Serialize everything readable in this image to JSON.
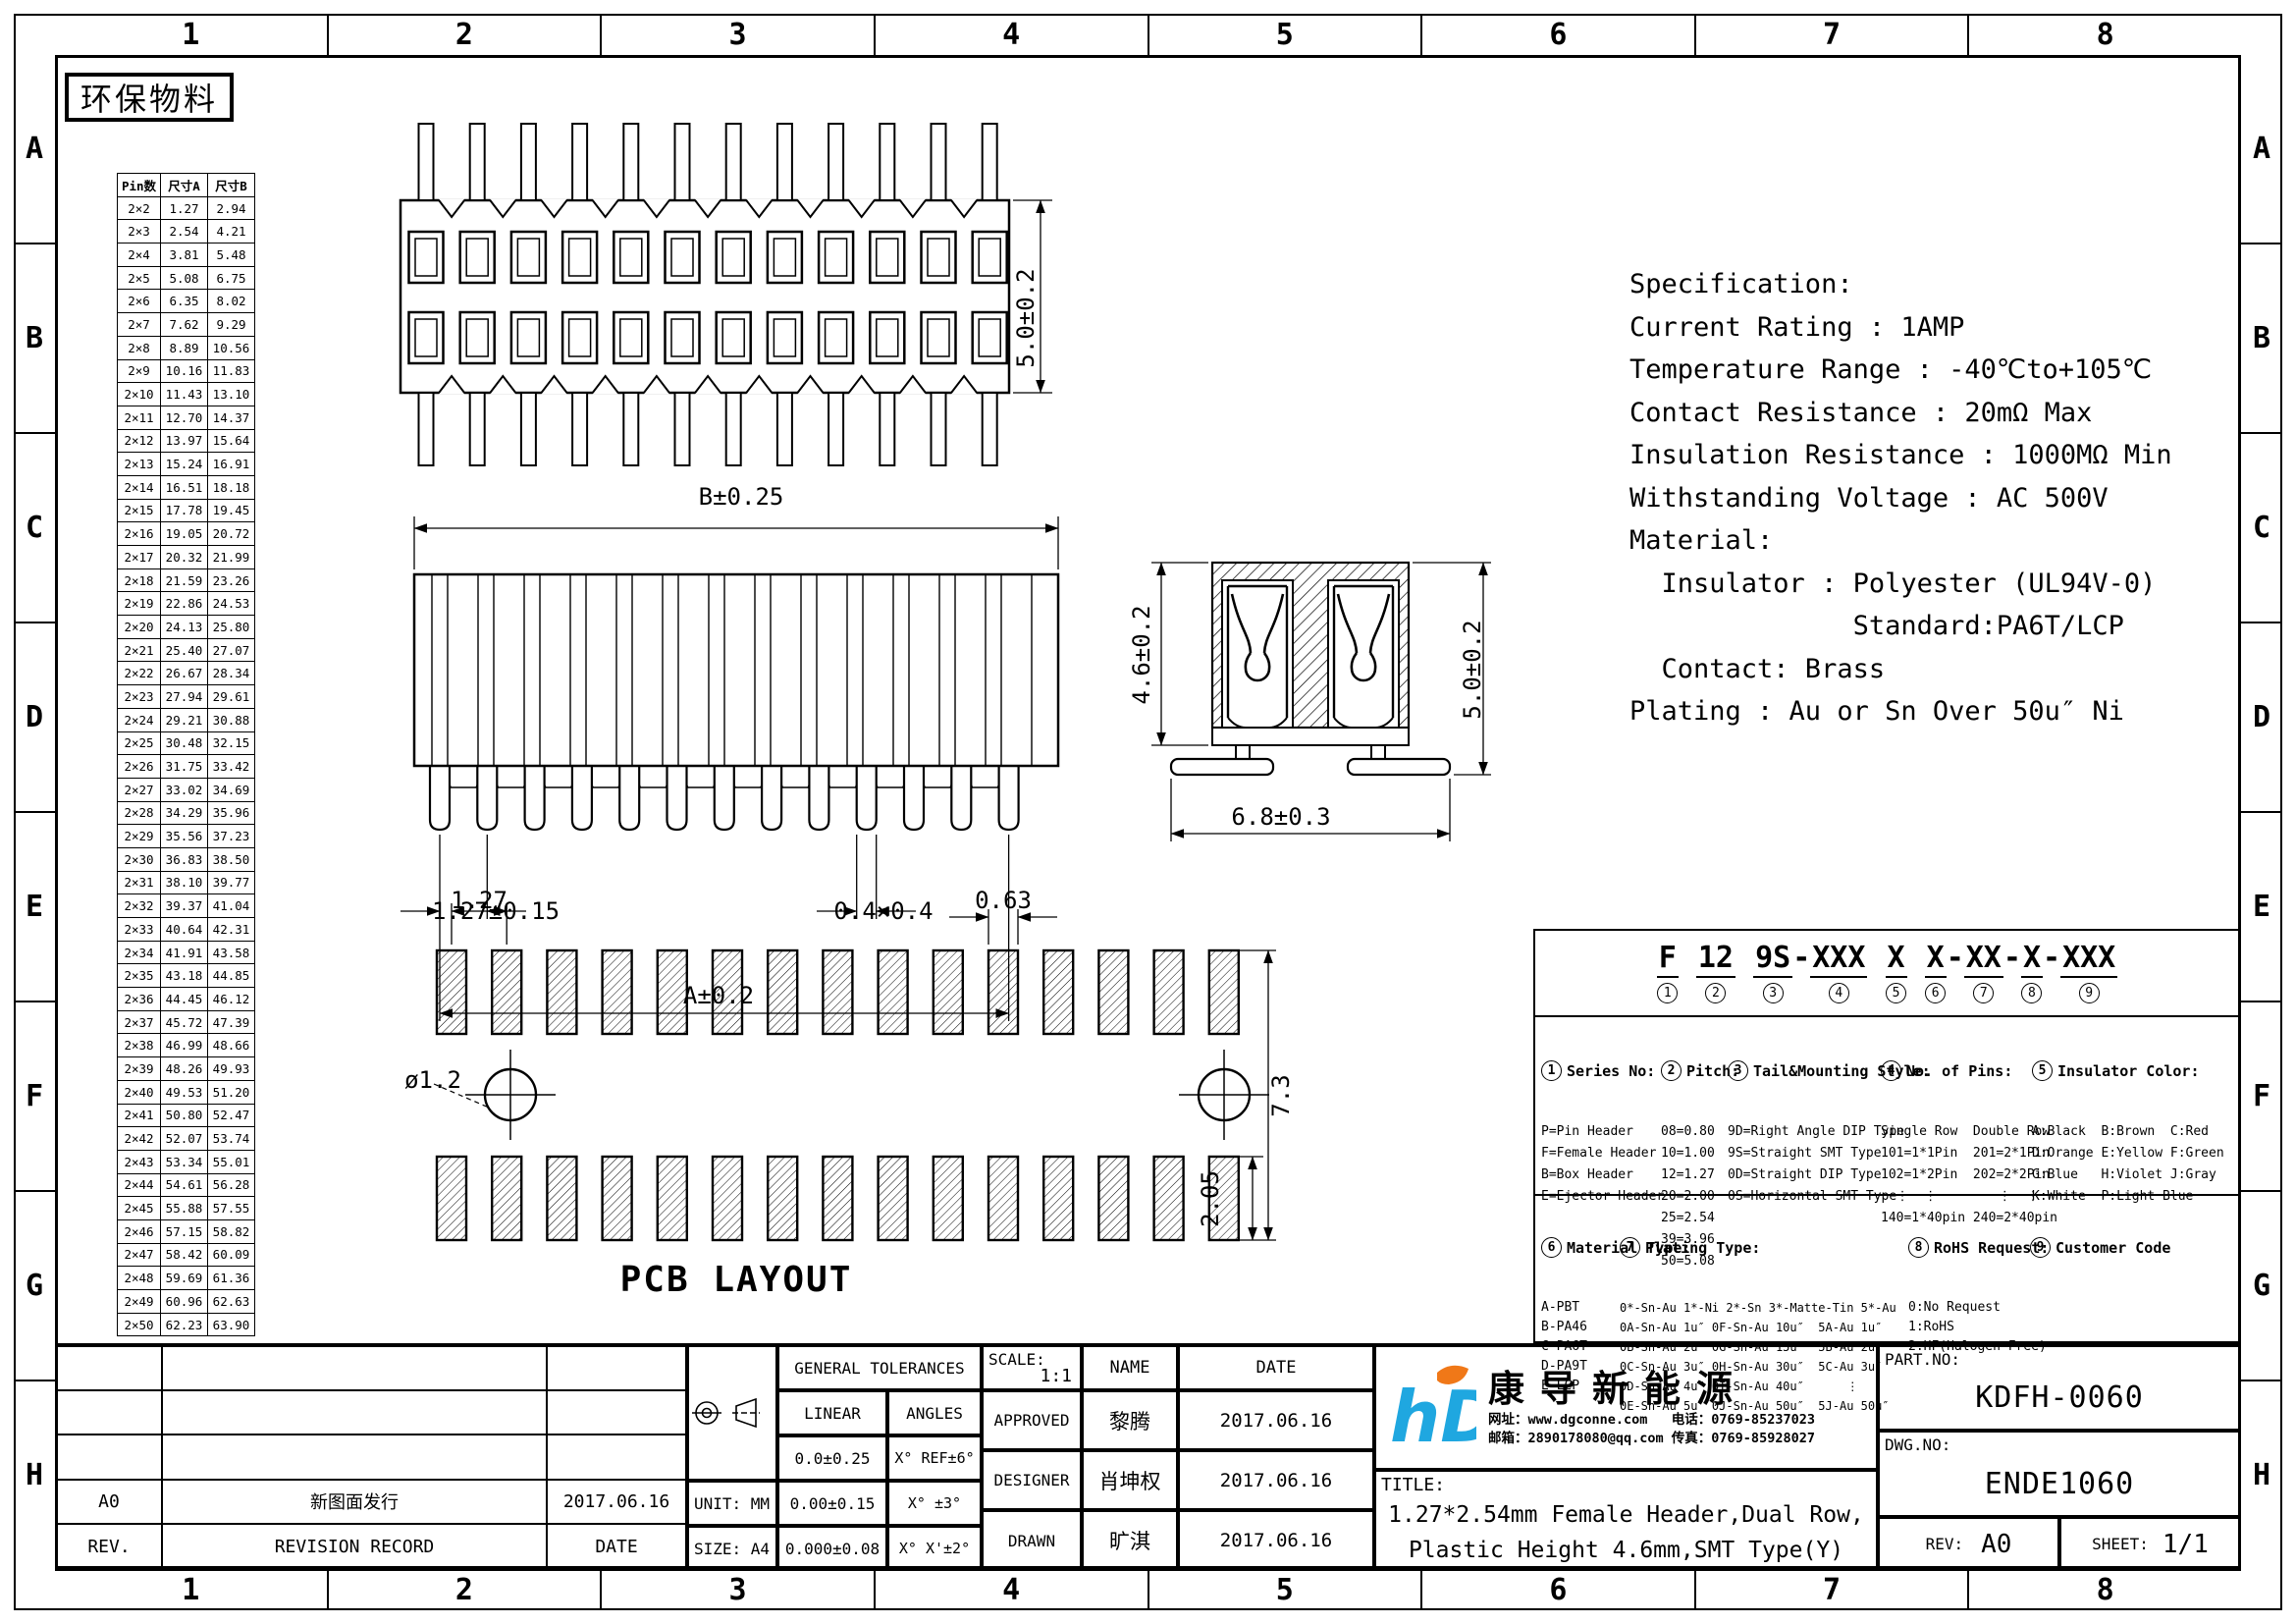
{
  "stamp": "环保物料",
  "zones": {
    "cols": [
      "1",
      "2",
      "3",
      "4",
      "5",
      "6",
      "7",
      "8"
    ],
    "rows": [
      "A",
      "B",
      "C",
      "D",
      "E",
      "F",
      "G",
      "H"
    ]
  },
  "pin_table": {
    "headers": [
      "Pin数",
      "尺寸A",
      "尺寸B"
    ],
    "rows": [
      [
        "2×2",
        "1.27",
        "2.94"
      ],
      [
        "2×3",
        "2.54",
        "4.21"
      ],
      [
        "2×4",
        "3.81",
        "5.48"
      ],
      [
        "2×5",
        "5.08",
        "6.75"
      ],
      [
        "2×6",
        "6.35",
        "8.02"
      ],
      [
        "2×7",
        "7.62",
        "9.29"
      ],
      [
        "2×8",
        "8.89",
        "10.56"
      ],
      [
        "2×9",
        "10.16",
        "11.83"
      ],
      [
        "2×10",
        "11.43",
        "13.10"
      ],
      [
        "2×11",
        "12.70",
        "14.37"
      ],
      [
        "2×12",
        "13.97",
        "15.64"
      ],
      [
        "2×13",
        "15.24",
        "16.91"
      ],
      [
        "2×14",
        "16.51",
        "18.18"
      ],
      [
        "2×15",
        "17.78",
        "19.45"
      ],
      [
        "2×16",
        "19.05",
        "20.72"
      ],
      [
        "2×17",
        "20.32",
        "21.99"
      ],
      [
        "2×18",
        "21.59",
        "23.26"
      ],
      [
        "2×19",
        "22.86",
        "24.53"
      ],
      [
        "2×20",
        "24.13",
        "25.80"
      ],
      [
        "2×21",
        "25.40",
        "27.07"
      ],
      [
        "2×22",
        "26.67",
        "28.34"
      ],
      [
        "2×23",
        "27.94",
        "29.61"
      ],
      [
        "2×24",
        "29.21",
        "30.88"
      ],
      [
        "2×25",
        "30.48",
        "32.15"
      ],
      [
        "2×26",
        "31.75",
        "33.42"
      ],
      [
        "2×27",
        "33.02",
        "34.69"
      ],
      [
        "2×28",
        "34.29",
        "35.96"
      ],
      [
        "2×29",
        "35.56",
        "37.23"
      ],
      [
        "2×30",
        "36.83",
        "38.50"
      ],
      [
        "2×31",
        "38.10",
        "39.77"
      ],
      [
        "2×32",
        "39.37",
        "41.04"
      ],
      [
        "2×33",
        "40.64",
        "42.31"
      ],
      [
        "2×34",
        "41.91",
        "43.58"
      ],
      [
        "2×35",
        "43.18",
        "44.85"
      ],
      [
        "2×36",
        "44.45",
        "46.12"
      ],
      [
        "2×37",
        "45.72",
        "47.39"
      ],
      [
        "2×38",
        "46.99",
        "48.66"
      ],
      [
        "2×39",
        "48.26",
        "49.93"
      ],
      [
        "2×40",
        "49.53",
        "51.20"
      ],
      [
        "2×41",
        "50.80",
        "52.47"
      ],
      [
        "2×42",
        "52.07",
        "53.74"
      ],
      [
        "2×43",
        "53.34",
        "55.01"
      ],
      [
        "2×44",
        "54.61",
        "56.28"
      ],
      [
        "2×45",
        "55.88",
        "57.55"
      ],
      [
        "2×46",
        "57.15",
        "58.82"
      ],
      [
        "2×47",
        "58.42",
        "60.09"
      ],
      [
        "2×48",
        "59.69",
        "61.36"
      ],
      [
        "2×49",
        "60.96",
        "62.63"
      ],
      [
        "2×50",
        "62.23",
        "63.90"
      ]
    ]
  },
  "dims": {
    "top_height": "5.0±0.2",
    "body_width": "B±0.25",
    "pin_pitch": "1.27±0.15",
    "pin_size": "0.4×0.4",
    "pin_span": "A±0.2",
    "sec_insulator_h": "4.6±0.2",
    "sec_overall_h": "5.0±0.2",
    "sec_foot_span": "6.8±0.3",
    "pcb_pitch": "1.27",
    "pcb_pad_w": "0.63",
    "pcb_hole": "ø1.2",
    "pcb_row_span": "7.3",
    "pcb_pad_h": "2.05",
    "pcb_caption": "PCB LAYOUT"
  },
  "specification": {
    "lines": [
      "Specification:",
      "Current Rating : 1AMP",
      "Temperature Range : -40℃to+105℃",
      "Contact Resistance : 20mΩ Max",
      "Insulation Resistance : 1000MΩ Min",
      "Withstanding Voltage : AC 500V",
      "Material:",
      "  Insulator : Polyester (UL94V-0)",
      "              Standard:PA6T/LCP",
      "  Contact: Brass",
      "Plating : Au or Sn Over 50u″ Ni"
    ]
  },
  "ordering": {
    "code_segments": [
      {
        "t": "F",
        "n": "1"
      },
      {
        "t": " "
      },
      {
        "t": "12",
        "n": "2"
      },
      {
        "t": " "
      },
      {
        "t": "9S",
        "n": "3"
      },
      {
        "t": "-"
      },
      {
        "t": "XXX",
        "n": "4"
      },
      {
        "t": " "
      },
      {
        "t": "X",
        "n": "5"
      },
      {
        "t": " "
      },
      {
        "t": "X",
        "n": "6"
      },
      {
        "t": "-"
      },
      {
        "t": "XX",
        "n": "7"
      },
      {
        "t": "-"
      },
      {
        "t": "X",
        "n": "8"
      },
      {
        "t": "-"
      },
      {
        "t": "XXX",
        "n": "9"
      }
    ],
    "sections": {
      "series": {
        "num": "1",
        "title": "Series No:",
        "items": [
          "P=Pin Header",
          "F=Female Header",
          "B=Box Header",
          "E=Ejector Header"
        ]
      },
      "pitch": {
        "num": "2",
        "title": "Pitch:",
        "items": [
          "08=0.80",
          "10=1.00",
          "12=1.27",
          "20=2.00",
          "25=2.54",
          "39=3.96",
          "50=5.08"
        ]
      },
      "tail": {
        "num": "3",
        "title": "Tail&Mounting Style:",
        "items": [
          "9D=Right Angle DIP Type",
          "9S=Straight SMT Type",
          "0D=Straight DIP Type",
          "0S=Horizontal SMT Type"
        ]
      },
      "pins": {
        "num": "4",
        "title": "No. of Pins:",
        "items": [
          "Single Row  Double Row",
          "101=1*1Pin  201=2*1Pin",
          "102=1*2Pin  202=2*2Pin",
          "  ⋮  ⋮        ⋮  ⋮",
          "140=1*40pin 240=2*40pin"
        ]
      },
      "color": {
        "num": "5",
        "title": "Insulator Color:",
        "items": [
          "A:Black  B:Brown  C:Red",
          "D:Orange E:Yellow F:Green",
          "G:Blue   H:Violet J:Gray",
          "K:White  P:Light Blue"
        ]
      },
      "material": {
        "num": "6",
        "title": "Material Type:",
        "items": [
          "A-PBT",
          "B-PA46",
          "C-PA6T",
          "D-PA9T",
          "E-LCP"
        ]
      },
      "plating": {
        "num": "7",
        "title": "Plating Type:",
        "items": [
          "0*-Sn-Au 1*-Ni 2*-Sn 3*-Matte-Tin 5*-Au",
          "0A-Sn-Au 1u″ 0F-Sn-Au 10u″  5A-Au 1u″",
          "0B-Sn-Au 2u″ 0G-Sn-Au 15u″  5B-Au 2u″",
          "0C-Sn-Au 3u″ 0H-Sn-Au 30u″  5C-Au 3u″",
          "0D-Sn-Au 4u″ 0I-Sn-Au 40u″      ⋮",
          "0E-Sn-Au 5u″ 0J-Sn-Au 50u″  5J-Au 50u″"
        ]
      },
      "rohs": {
        "num": "8",
        "title": "RoHS Request:",
        "items": [
          "0:No Request",
          "1:RoHS",
          "2:HF(Halogen Free)"
        ]
      },
      "customer": {
        "num": "9",
        "title": "Customer Code",
        "items": []
      }
    }
  },
  "title_block": {
    "revision": {
      "grid": [
        [
          "",
          "",
          ""
        ],
        [
          "",
          "",
          ""
        ],
        [
          "",
          "",
          ""
        ],
        [
          "A0",
          "新图面发行",
          "2017.06.16"
        ],
        [
          "REV.",
          "REVISION RECORD",
          "DATE"
        ]
      ]
    },
    "unit_label": "UNIT: MM",
    "size_label": "SIZE: A4",
    "tolerances": {
      "title": "GENERAL TOLERANCES",
      "linear_label": "LINEAR",
      "angles_label": "ANGLES",
      "rows": [
        [
          "0.0±0.25",
          "X° REF±6°"
        ],
        [
          "0.00±0.15",
          "X° ±3°"
        ],
        [
          "0.000±0.08",
          "X° X'±2°"
        ]
      ]
    },
    "scale_label": "SCALE:",
    "scale_value": "1:1",
    "name_label": "NAME",
    "date_label": "DATE",
    "people": [
      [
        "APPROVED",
        "黎腾",
        "2017.06.16"
      ],
      [
        "DESIGNER",
        "肖坤权",
        "2017.06.16"
      ],
      [
        "DRAWN",
        "旷淇",
        "2017.06.16"
      ]
    ],
    "title_label": "TITLE:",
    "title_lines": [
      "1.27*2.54mm Female Header,Dual Row,",
      "Plastic Height 4.6mm,SMT Type(Y)"
    ],
    "company": {
      "logo_text": "hD",
      "name": "康导新能源",
      "contact1": "网址：www.dgconne.com   电话：0769-85237023",
      "contact2": "邮箱：2890178080@qq.com 传真：0769-85928027"
    },
    "part_no_label": "PART.NO:",
    "part_no": "KDFH-0060",
    "dwg_no_label": "DWG.NO:",
    "dwg_no": "ENDE1060",
    "rev_label": "REV:",
    "rev": "A0",
    "sheet_label": "SHEET:",
    "sheet": "1/1"
  },
  "colors": {
    "logo_blue": "#1fa7e0",
    "logo_orange": "#f07818",
    "line": "#000000"
  }
}
